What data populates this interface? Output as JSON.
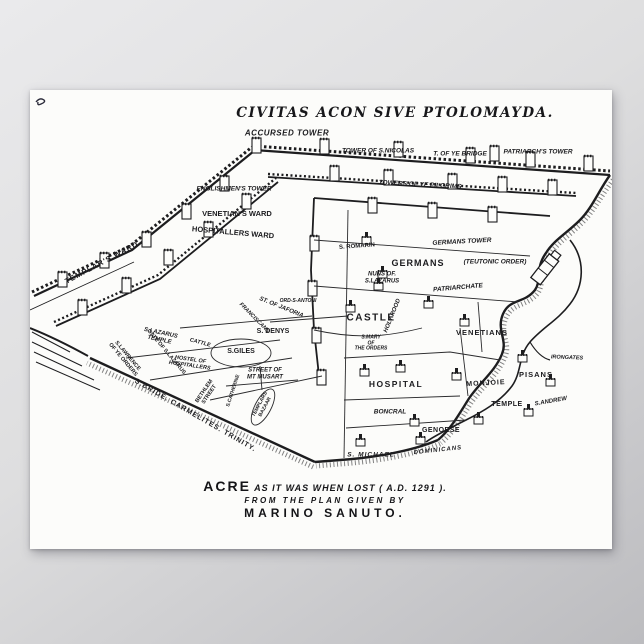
{
  "page": {
    "background_top": "#eaeaec",
    "background_bottom": "#bcbcbf",
    "poster_color": "#fcfcfa",
    "ink_color": "#1b1b1e"
  },
  "title": {
    "text": "CIVITAS ACON SIVE PTOLOMAYDA."
  },
  "caption": {
    "lead": "ACRE",
    "line1_rest": "AS IT WAS WHEN LOST ( A.D. 1291 ).",
    "line2": "FROM THE PLAN GIVEN BY",
    "line3": "MARINO SANUTO."
  },
  "labels": [
    {
      "name": "label-accursed-tower",
      "text": "ACCURSED TOWER",
      "x": 257,
      "y": 44,
      "size": 8,
      "italic": true,
      "spacing": 0.5
    },
    {
      "name": "label-tower-of-s-nicolas",
      "text": "TOWER OF S.NICOLAS",
      "x": 348,
      "y": 61,
      "size": 6.5,
      "italic": true
    },
    {
      "name": "label-t-of-ye-bridge",
      "text": "T. OF YE BRIDGE",
      "x": 430,
      "y": 64,
      "size": 6.5,
      "italic": true
    },
    {
      "name": "label-patriarchs-tower",
      "text": "PATRIARCH'S TOWER",
      "x": 508,
      "y": 62,
      "size": 6.5,
      "italic": true
    },
    {
      "name": "label-englishmens-tower",
      "text": "ENGLISHMEN'S TOWER",
      "x": 204,
      "y": 99,
      "size": 6.5,
      "italic": true
    },
    {
      "name": "label-towers-of-ye-pilgrims",
      "text": "TOWERS OF YE PILGRIMS",
      "x": 390,
      "y": 95,
      "size": 6.5,
      "italic": true,
      "rotate": 3
    },
    {
      "name": "label-venetians-ward",
      "text": "VENETIAN'S WARD",
      "x": 207,
      "y": 124,
      "size": 7.5
    },
    {
      "name": "label-hospitallers-ward",
      "text": "HOSPITALLERS WARD",
      "x": 203,
      "y": 143,
      "size": 7.5,
      "rotate": 5
    },
    {
      "name": "label-templars-ward",
      "text": "TEMPLAR'S WARD",
      "x": 72,
      "y": 173,
      "size": 7.5,
      "rotate": -28,
      "spacing": 1
    },
    {
      "name": "label-s-romarin",
      "text": "S. ROMARIN",
      "x": 327,
      "y": 157,
      "size": 6,
      "rotate": -4
    },
    {
      "name": "label-germans-tower",
      "text": "GERMANS TOWER",
      "x": 432,
      "y": 152,
      "size": 6.5,
      "italic": true,
      "rotate": -3
    },
    {
      "name": "label-germans",
      "text": "GERMANS",
      "x": 388,
      "y": 173,
      "size": 9,
      "spacing": 1
    },
    {
      "name": "label-teutonic-order",
      "text": "(TEUTONIC ORDER)",
      "x": 465,
      "y": 172,
      "size": 6.5,
      "italic": true
    },
    {
      "name": "label-nuns-of-s-lazarus",
      "text": "NUNS OF.\nS.LAZARUS",
      "x": 352,
      "y": 188,
      "size": 6,
      "italic": true
    },
    {
      "name": "label-patriarchate",
      "text": "PATRIARCHATE",
      "x": 428,
      "y": 198,
      "size": 6.5,
      "italic": true,
      "rotate": -5
    },
    {
      "name": "label-castle",
      "text": "CASTLE",
      "x": 341,
      "y": 228,
      "size": 10,
      "spacing": 1.5
    },
    {
      "name": "label-holy-rood",
      "text": "HOLY ROOD",
      "x": 363,
      "y": 226,
      "size": 6,
      "italic": true,
      "rotate": -68
    },
    {
      "name": "label-s-mary-of-the-orders",
      "text": "S.MARY\nOF\nTHE ORDERS",
      "x": 341,
      "y": 254,
      "size": 5,
      "italic": true
    },
    {
      "name": "label-venetians",
      "text": "VENETIANS",
      "x": 452,
      "y": 243,
      "size": 7.5,
      "spacing": 1
    },
    {
      "name": "label-gate-of-s-lazarus",
      "text": "GATE OF S.LAZARUS",
      "x": 136,
      "y": 262,
      "size": 5.5,
      "rotate": 50
    },
    {
      "name": "label-s-lawrence-of-ye-orders",
      "text": "S.LAWRENCE\nOF YE ORDERS",
      "x": 95,
      "y": 268,
      "size": 5.5,
      "rotate": 50
    },
    {
      "name": "label-st-of-jaforia",
      "text": "ST. OF JAFORIA",
      "x": 251,
      "y": 218,
      "size": 6,
      "italic": true,
      "rotate": 22
    },
    {
      "name": "label-franciscans",
      "text": "FRANCISCANS",
      "x": 224,
      "y": 228,
      "size": 5.5,
      "italic": true,
      "rotate": 45
    },
    {
      "name": "label-ord-s-antoni",
      "text": "ORD-S-ANTONI",
      "x": 268,
      "y": 212,
      "size": 5,
      "italic": true
    },
    {
      "name": "label-s-lazarus-temple",
      "text": "S.LAZARUS\nTEMPLE",
      "x": 130,
      "y": 247,
      "size": 6,
      "italic": true,
      "rotate": 12
    },
    {
      "name": "label-cattle",
      "text": "CATTLE",
      "x": 170,
      "y": 253,
      "size": 5.5,
      "italic": true,
      "rotate": 15
    },
    {
      "name": "label-s-denys",
      "text": "S. DENYS",
      "x": 243,
      "y": 242,
      "size": 7
    },
    {
      "name": "label-s-giles",
      "text": "S.GILES",
      "x": 211,
      "y": 262,
      "size": 7
    },
    {
      "name": "label-hostel-of-hospitallers",
      "text": "HOSTEL OF\nHOSPITALLERS",
      "x": 160,
      "y": 273,
      "size": 5.5,
      "italic": true,
      "rotate": 8
    },
    {
      "name": "label-street-of-mt-musart",
      "text": "STREET OF\nMT MUSART",
      "x": 235,
      "y": 284,
      "size": 6,
      "italic": true
    },
    {
      "name": "label-bethlem-street",
      "text": "BETHLEM\nSTREET",
      "x": 177,
      "y": 303,
      "size": 5.5,
      "rotate": -56
    },
    {
      "name": "label-s-catherine",
      "text": "S.CATHERINE",
      "x": 204,
      "y": 301,
      "size": 5,
      "rotate": -72
    },
    {
      "name": "label-templars-bazaar",
      "text": "TEMPLARS\nBAZAAR",
      "x": 233,
      "y": 316,
      "size": 5,
      "rotate": -62
    },
    {
      "name": "label-s-bride-carmelites-trinity",
      "text": "S.BRIDE.  CARMELITES.  TRINITY.",
      "x": 165,
      "y": 326,
      "size": 7,
      "rotate": 30,
      "spacing": 1
    },
    {
      "name": "label-hospital",
      "text": "HOSPITAL",
      "x": 366,
      "y": 295,
      "size": 8.5,
      "spacing": 1.5
    },
    {
      "name": "label-monjoie",
      "text": "MONJOIE",
      "x": 456,
      "y": 294,
      "size": 7,
      "rotate": -3,
      "spacing": 1
    },
    {
      "name": "label-pisans",
      "text": "PISANS",
      "x": 506,
      "y": 285,
      "size": 7.5,
      "spacing": 1
    },
    {
      "name": "label-irongates",
      "text": "IRONGATES",
      "x": 537,
      "y": 268,
      "size": 5.5,
      "italic": true,
      "rotate": 2
    },
    {
      "name": "label-temple",
      "text": "TEMPLE",
      "x": 477,
      "y": 315,
      "size": 7,
      "spacing": 0.5
    },
    {
      "name": "label-s-andrew",
      "text": "S.ANDREW",
      "x": 521,
      "y": 312,
      "size": 6,
      "italic": true,
      "rotate": -10
    },
    {
      "name": "label-boncral",
      "text": "BONCRAL",
      "x": 360,
      "y": 322,
      "size": 6.5,
      "italic": true
    },
    {
      "name": "label-genoese",
      "text": "GENOESE",
      "x": 411,
      "y": 341,
      "size": 7,
      "spacing": 0.5
    },
    {
      "name": "label-s-michael",
      "text": "S. MICHAEL",
      "x": 341,
      "y": 365,
      "size": 6.5,
      "italic": true,
      "spacing": 1
    },
    {
      "name": "label-dominicans",
      "text": "DOMINICANS",
      "x": 408,
      "y": 361,
      "size": 6,
      "italic": true,
      "rotate": -6,
      "spacing": 1
    }
  ]
}
